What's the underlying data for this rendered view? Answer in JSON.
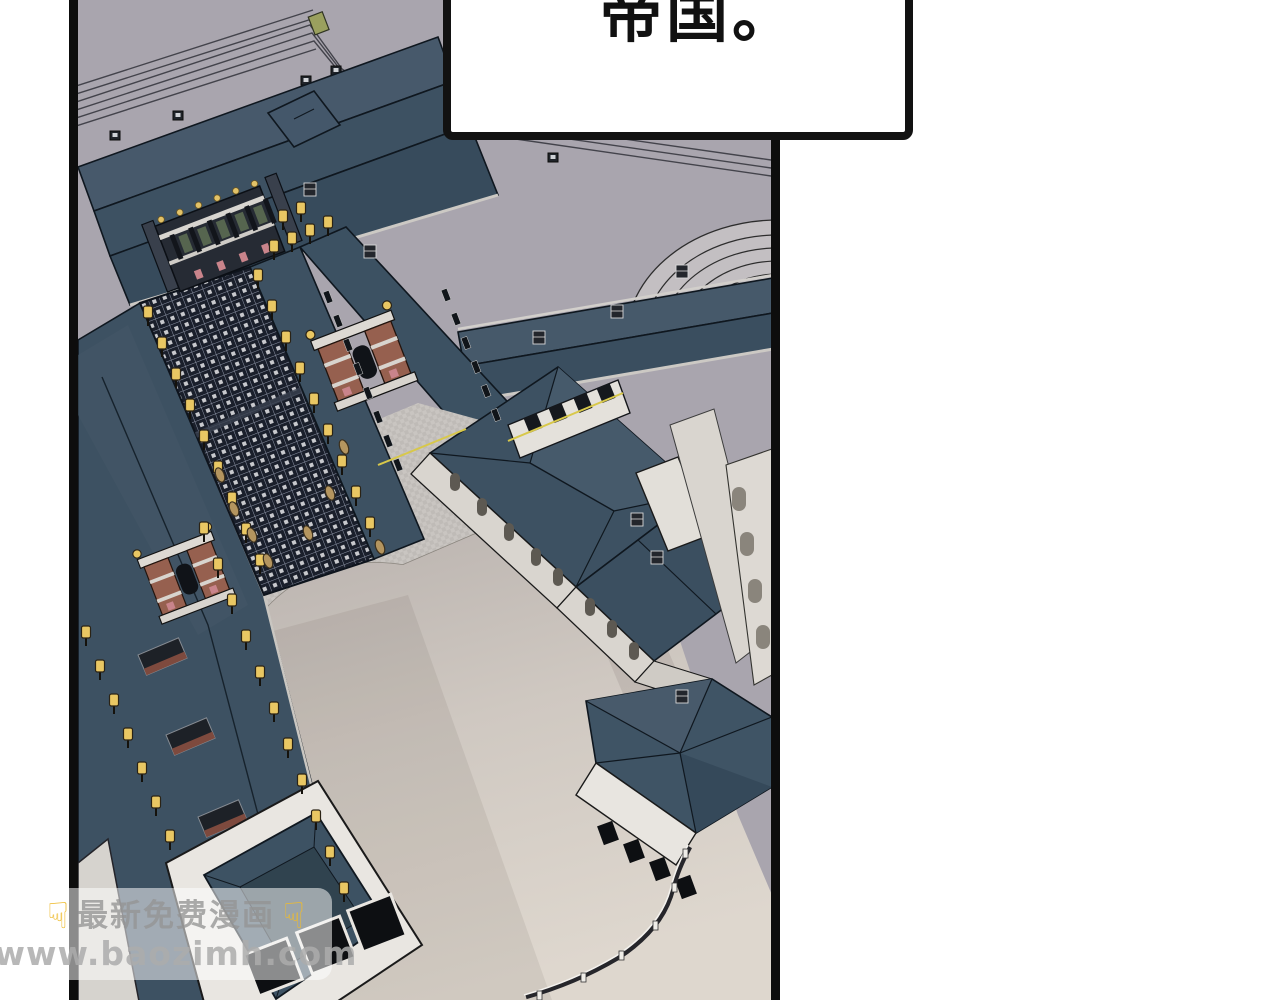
{
  "scene": {
    "label": "palace-aerial-view-illustration"
  },
  "speech_bubble": {
    "text": "帝国。"
  },
  "watermark": {
    "line1": "最新免费漫画",
    "line2": "www.baozimh.com",
    "pointer_glyph": "☟"
  },
  "colors": {
    "panel_border": "#0d0d0d",
    "ground": "#a9a5ae",
    "roof": "#3d5162",
    "roof_light": "#47596b",
    "plaza": "#d8d1c9",
    "lantern": "#e9c763",
    "brick": "#96604f",
    "accent_pink": "#c9848b",
    "trim_yellow": "#d8c84a"
  }
}
